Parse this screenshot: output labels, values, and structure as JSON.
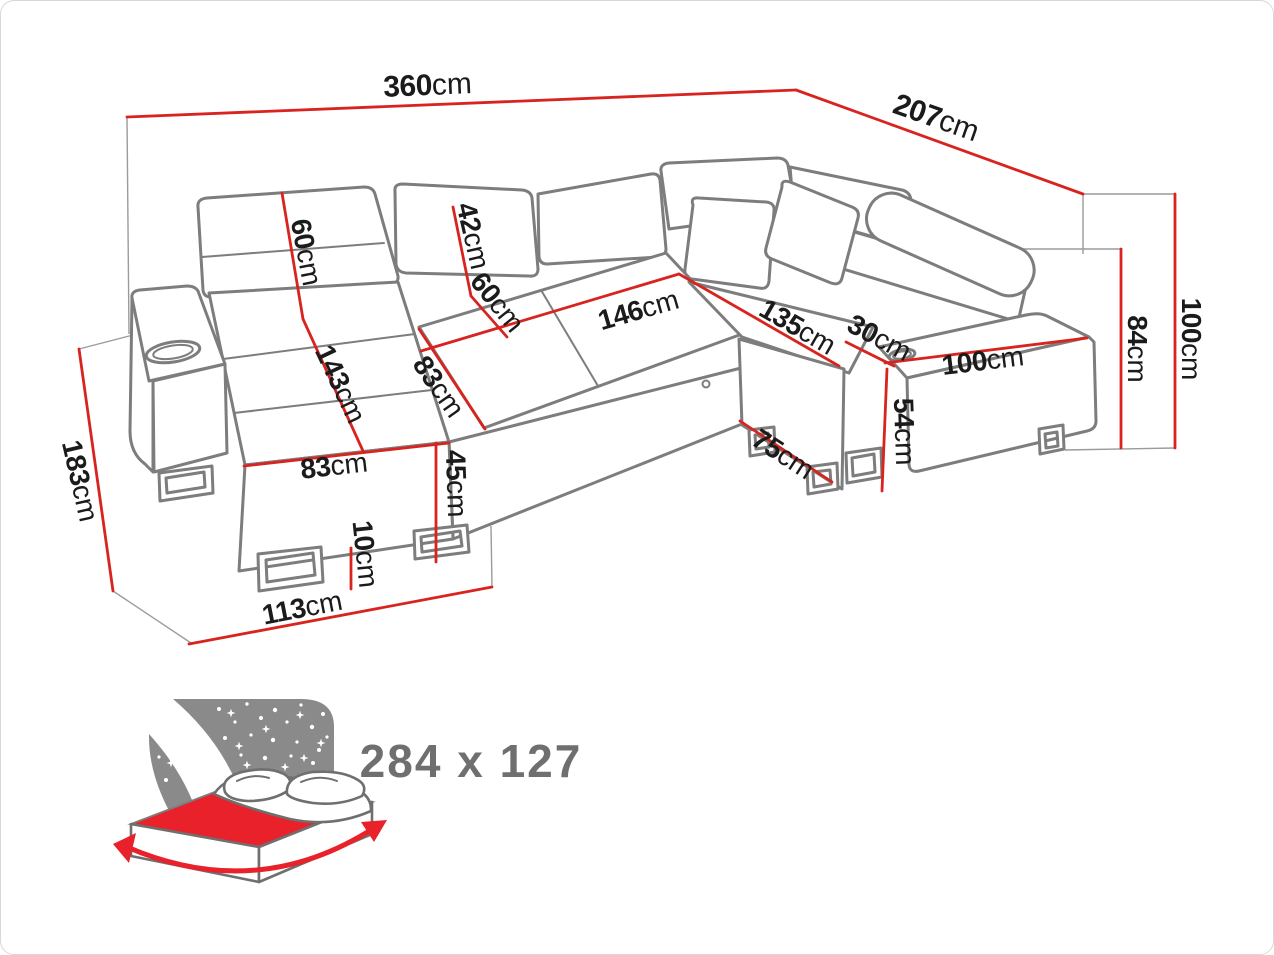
{
  "diagram": {
    "kind": "corner-sofa-dimension-diagram",
    "unit_system": "cm",
    "colors": {
      "dimension_line": "#d8231f",
      "sofa_outline": "#7d7d7d",
      "label_text": "#1b1b1b",
      "icon_gray": "#8a8a8a",
      "icon_red": "#e8212a",
      "icon_text": "#6f6f6f"
    },
    "dimensions": {
      "width_total": {
        "value": "360",
        "unit": "cm"
      },
      "depth_total": {
        "value": "207",
        "unit": "cm"
      },
      "height_total": {
        "value": "100",
        "unit": "cm"
      },
      "height_backrest": {
        "value": "84",
        "unit": "cm"
      },
      "chaise_depth": {
        "value": "183",
        "unit": "cm"
      },
      "back_cushion_left": {
        "value": "60",
        "unit": "cm"
      },
      "headrest": {
        "value": "42",
        "unit": "cm"
      },
      "back_cushion_mid": {
        "value": "60",
        "unit": "cm"
      },
      "seat_width_middle": {
        "value": "146",
        "unit": "cm"
      },
      "chaise_length": {
        "value": "143",
        "unit": "cm"
      },
      "seat_depth": {
        "value": "83",
        "unit": "cm"
      },
      "chaise_front_width": {
        "value": "83",
        "unit": "cm"
      },
      "seat_height": {
        "value": "45",
        "unit": "cm"
      },
      "leg_height": {
        "value": "10",
        "unit": "cm"
      },
      "chaise_base_depth": {
        "value": "113",
        "unit": "cm"
      },
      "seat_length_right": {
        "value": "135",
        "unit": "cm"
      },
      "armrest_width": {
        "value": "30",
        "unit": "cm"
      },
      "base_height_right": {
        "value": "54",
        "unit": "cm"
      },
      "base_depth_right": {
        "value": "75",
        "unit": "cm"
      },
      "section_width_right": {
        "value": "100",
        "unit": "cm"
      }
    },
    "sleeping_function": {
      "icon": "fold-out-bed-night-icon",
      "bed_size": "284 x 127"
    }
  }
}
